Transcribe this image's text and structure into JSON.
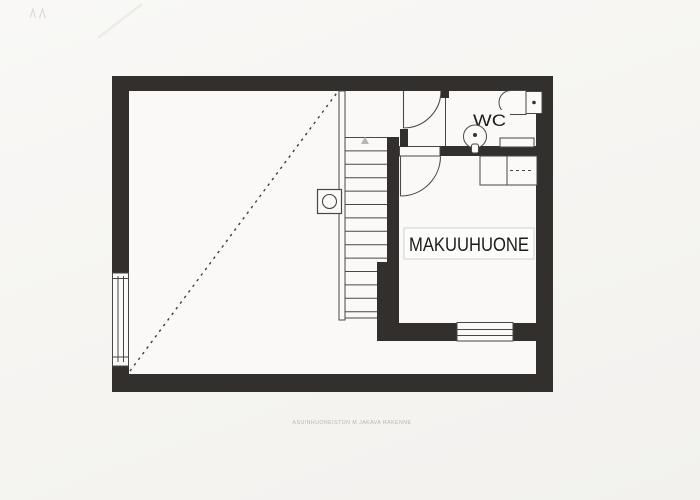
{
  "document": {
    "paper_color": "#f6f5f2",
    "wall_ink_color": "#332f2c",
    "thin_line_color": "#474747"
  },
  "rooms": {
    "wc": {
      "label": "WC"
    },
    "bedroom": {
      "label": "MAKUUHUONE"
    }
  },
  "stairs": {
    "tread_count": 13,
    "direction_marker": "up-arrow"
  },
  "fixtures": [
    "toilet-icon",
    "sink-icon",
    "staircase-icon",
    "wardrobe-icon",
    "flue-icon",
    "window-icon",
    "door-swing-icon"
  ],
  "footer": {
    "caption": "ASUINHUONEISTON M JAKAVA RAKENNE"
  }
}
